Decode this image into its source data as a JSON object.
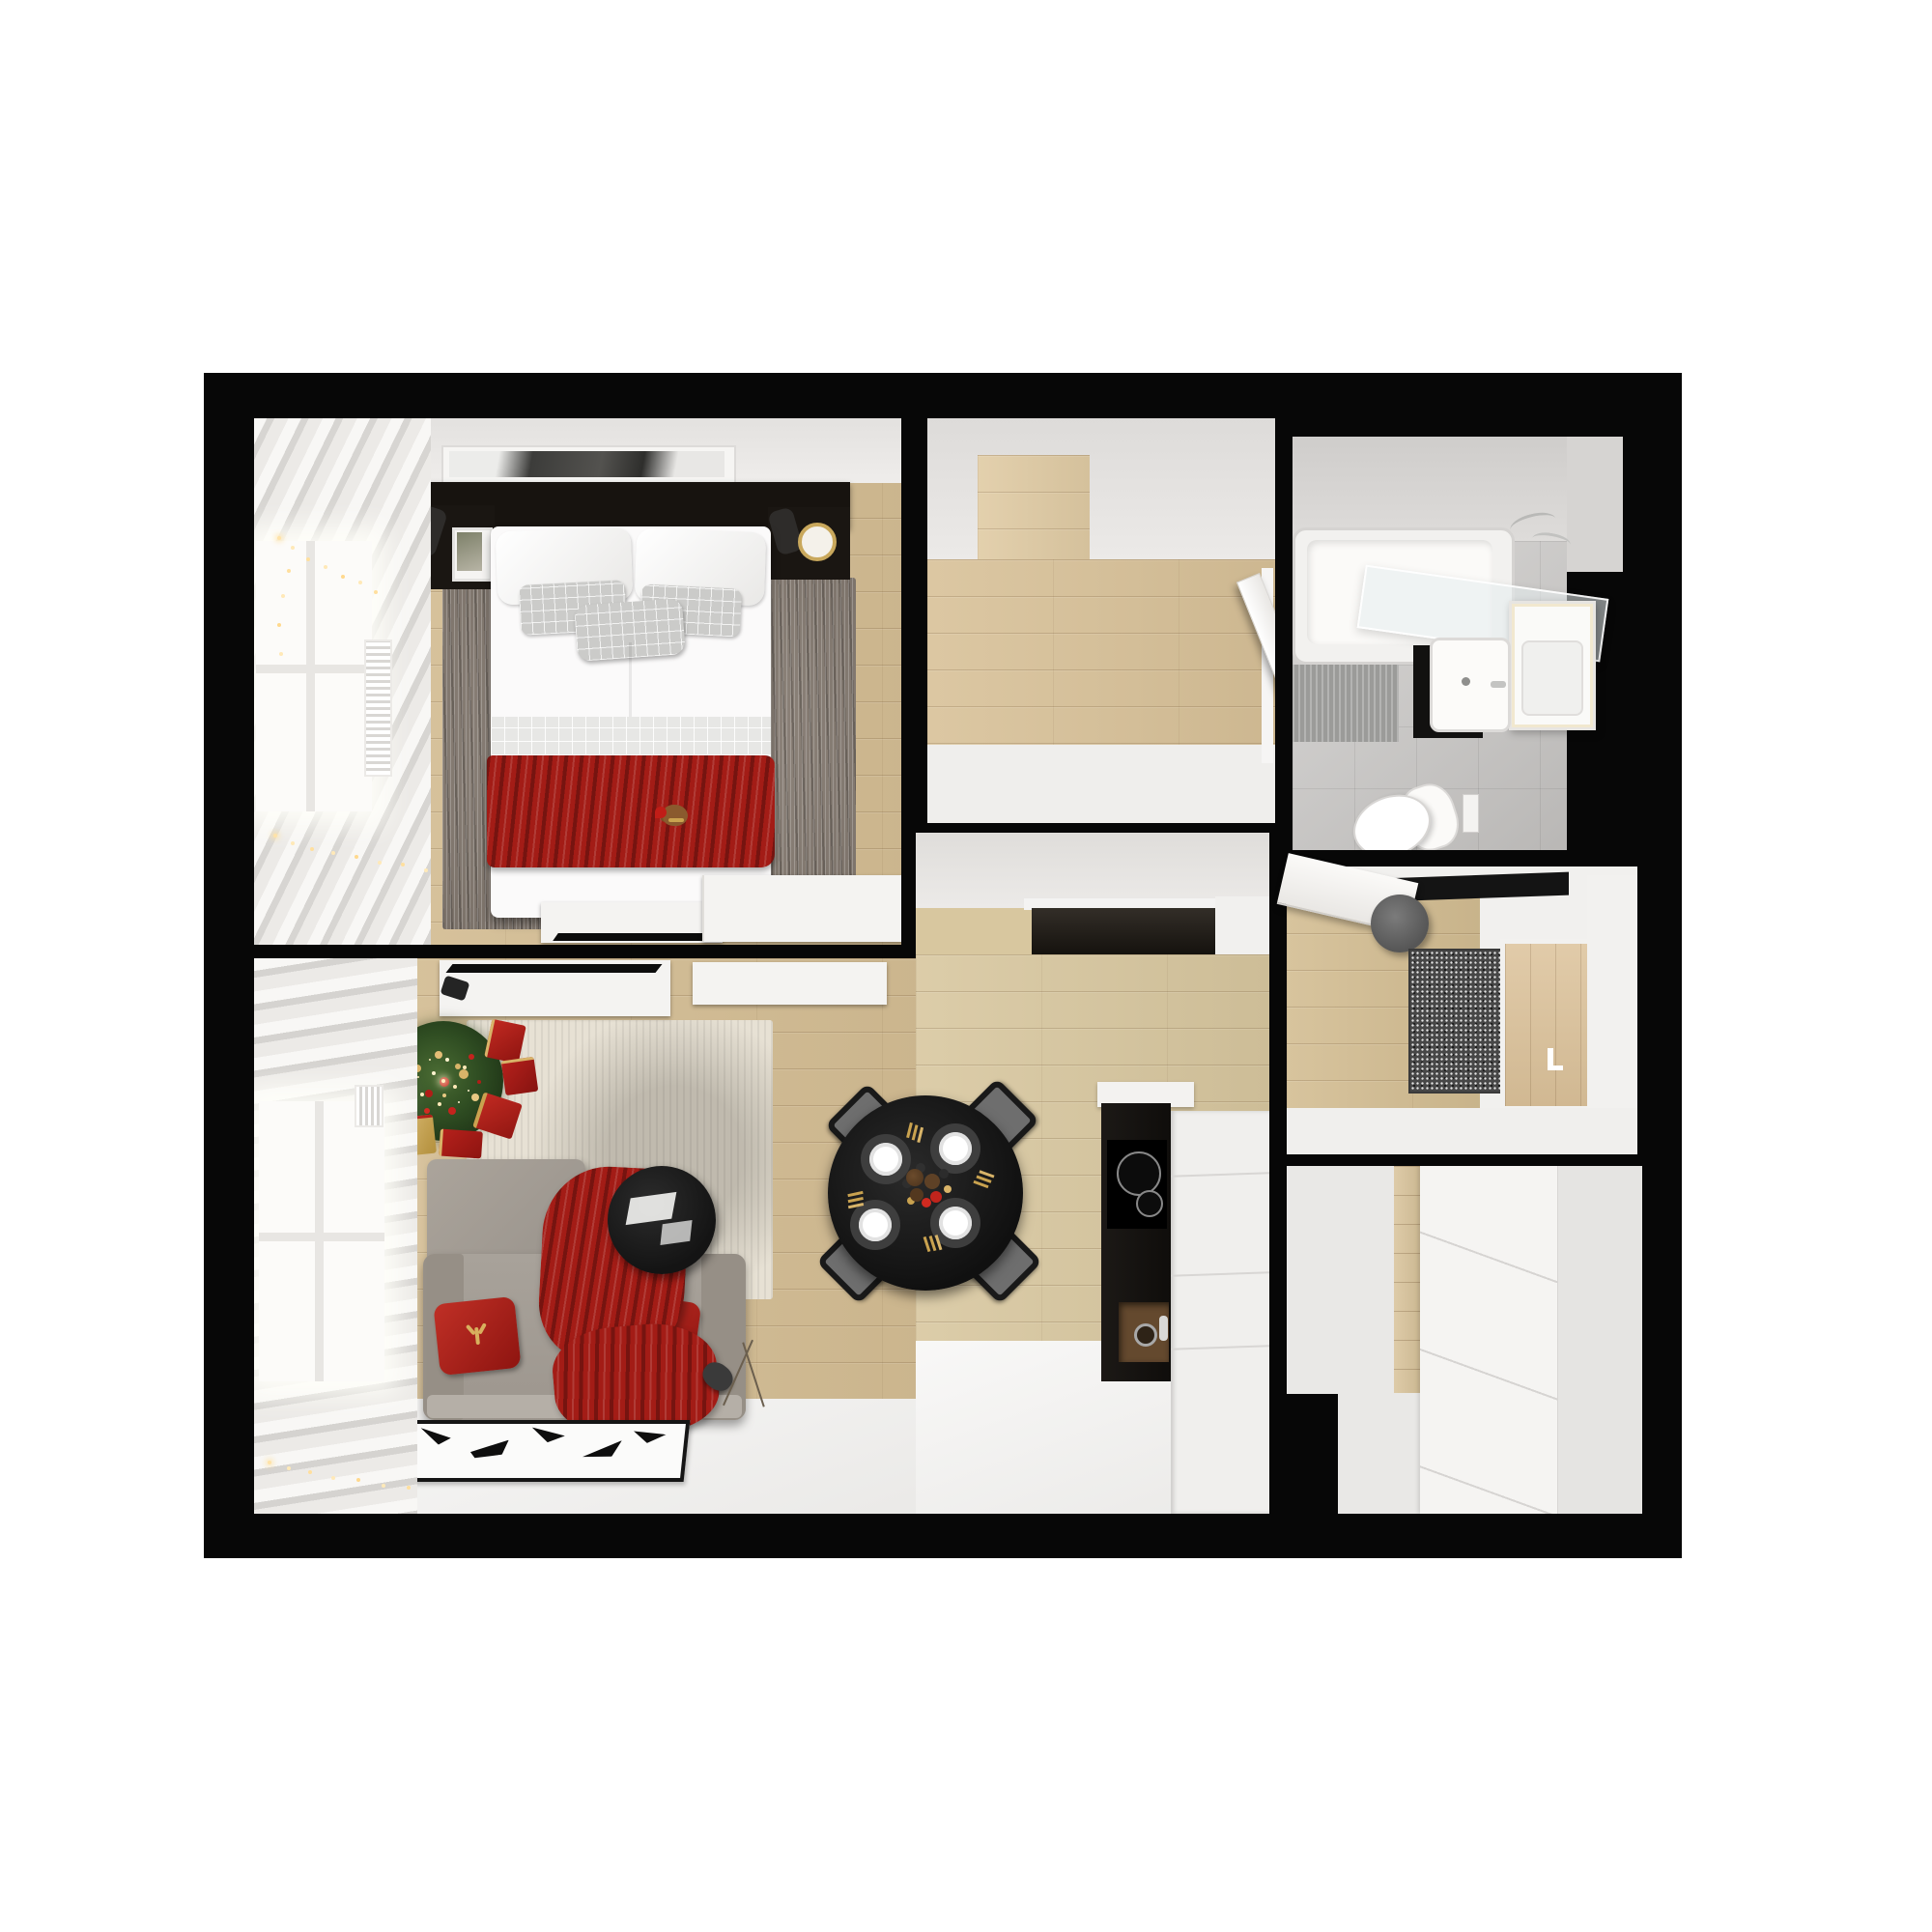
{
  "scene": {
    "kind": "apartment-floor-plan-top-down-render",
    "style": "photoreal 3d dollhouse view",
    "theme": "christmas-decorated one-bedroom apartment",
    "background": "#ffffff",
    "walls": "#070707"
  },
  "palette": {
    "wall_black": "#070707",
    "wood_floor": "#d6bf95",
    "wood_floor_light": "#decaa2",
    "white_floor": "#f2f1ef",
    "ceiling_band": "#eae8e6",
    "tile_gray": "#c9c7c5",
    "rug_gray": "#8e8379",
    "rug_beige": "#e7e1d4",
    "accent_red": "#a31c16",
    "accent_gold": "#c9a24f",
    "sofa_gray": "#a8a29a",
    "furniture_black": "#161412",
    "tree_green": "#2f4d22"
  },
  "rooms": [
    {
      "name": "bedroom",
      "position": "top-left",
      "furniture": [
        "window-with-curtains",
        "string-lights",
        "wall-art",
        "black-headboard-shelf",
        "nightstand-left-with-photo",
        "nightstand-right-with-clock",
        "reading-lamps",
        "double-bed-white-duvet",
        "gray-plaid-pillows",
        "red-runner-blanket",
        "teddy-bear-santa-hat",
        "gray-area-rug",
        "low-dressers-with-tv"
      ]
    },
    {
      "name": "hallway",
      "position": "top-middle",
      "furniture": [
        "wood-floor",
        "entry-door-ajar"
      ]
    },
    {
      "name": "bathroom",
      "position": "top-right",
      "furniture": [
        "bathtub",
        "glass-shower-screen",
        "mirror-cabinet",
        "black-vanity-white-basin",
        "toilet",
        "flush-plate",
        "bath-mat",
        "chrome-shower-set"
      ]
    },
    {
      "name": "dressing-office-room",
      "position": "right-middle",
      "furniture": [
        "white-door-ajar",
        "black-wall-shelf",
        "gray-pouf",
        "speckled-rug",
        "wood-panel-niche-with-handle"
      ]
    },
    {
      "name": "living-dining-kitchen",
      "position": "bottom-left-center",
      "furniture": [
        "window-with-curtains",
        "christmas-tree",
        "gift-boxes",
        "tv-sideboards",
        "corner-sofa-gray",
        "red-knit-blanket",
        "red-deer-pillows",
        "round-coffee-table",
        "floor-lamp",
        "black-white-pattern-rug",
        "round-black-dining-table",
        "four-black-chairs",
        "place-settings-gold-cutlery",
        "festive-centerpiece",
        "kitchen-counter-black",
        "induction-cooktop",
        "kitchen-sink",
        "tall-white-cabinets"
      ]
    },
    {
      "name": "closet-room",
      "position": "bottom-right",
      "furniture": [
        "white-wardrobe-fronts",
        "wood-floor-strip"
      ]
    }
  ]
}
